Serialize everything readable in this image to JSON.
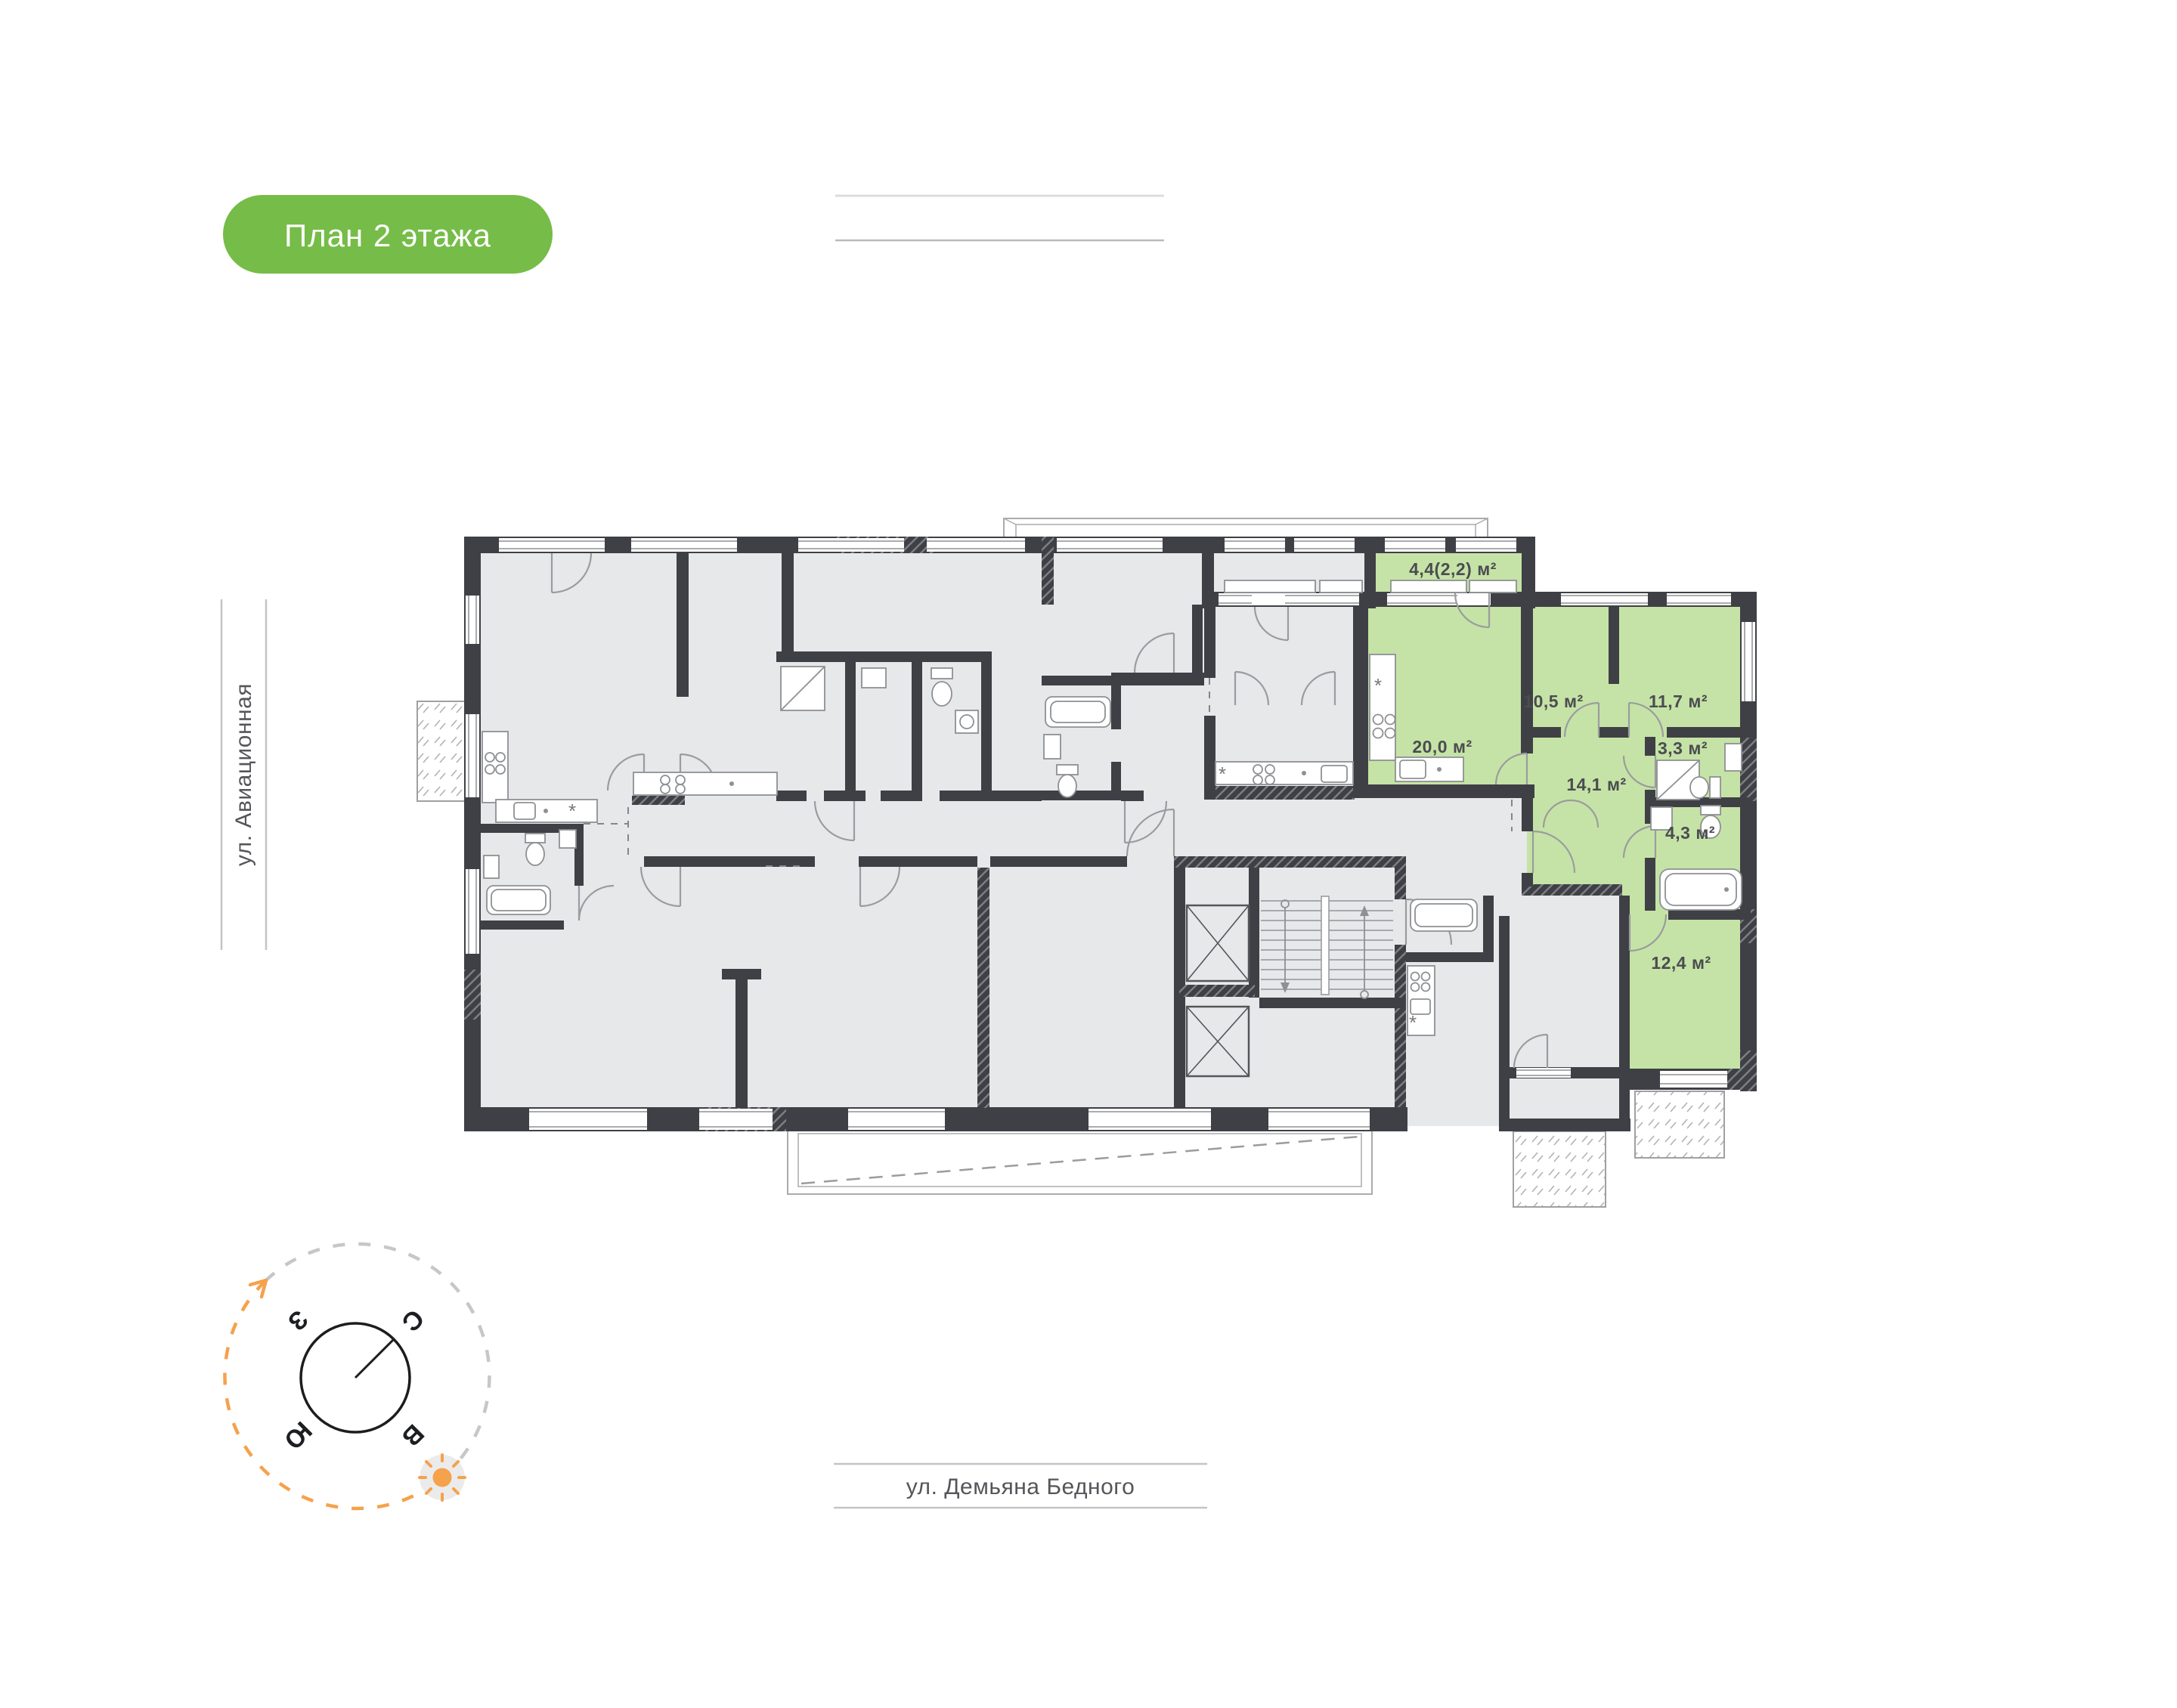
{
  "badge": {
    "label": "План 2 этажа",
    "bg_color": "#76bc48",
    "text_color": "#ffffff"
  },
  "streets": {
    "left": {
      "name": "ул. Авиационная"
    },
    "bottom": {
      "name": "ул. Демьяна Бедного"
    }
  },
  "compass": {
    "letters": {
      "north": "С",
      "east": "В",
      "south": "Ю",
      "west": "З"
    },
    "accent_color": "#f6a14c"
  },
  "floor_plan": {
    "wall_color": "#3f4045",
    "room_fill": "#e7e8ea",
    "highlight_color": "#c5e3a6",
    "highlighted_apartment": {
      "rooms": [
        {
          "name": "balcony",
          "area": "4,4(2,2) м²"
        },
        {
          "name": "kitchen-living-room",
          "area": "20,0 м²"
        },
        {
          "name": "bedroom-1",
          "area": "10,5 м²"
        },
        {
          "name": "bedroom-2",
          "area": "11,7 м²"
        },
        {
          "name": "bathroom-1",
          "area": "3,3 м²"
        },
        {
          "name": "hallway",
          "area": "14,1 м²"
        },
        {
          "name": "bathroom-2",
          "area": "4,3 м²"
        },
        {
          "name": "room",
          "area": "12,4 м²"
        }
      ]
    }
  }
}
